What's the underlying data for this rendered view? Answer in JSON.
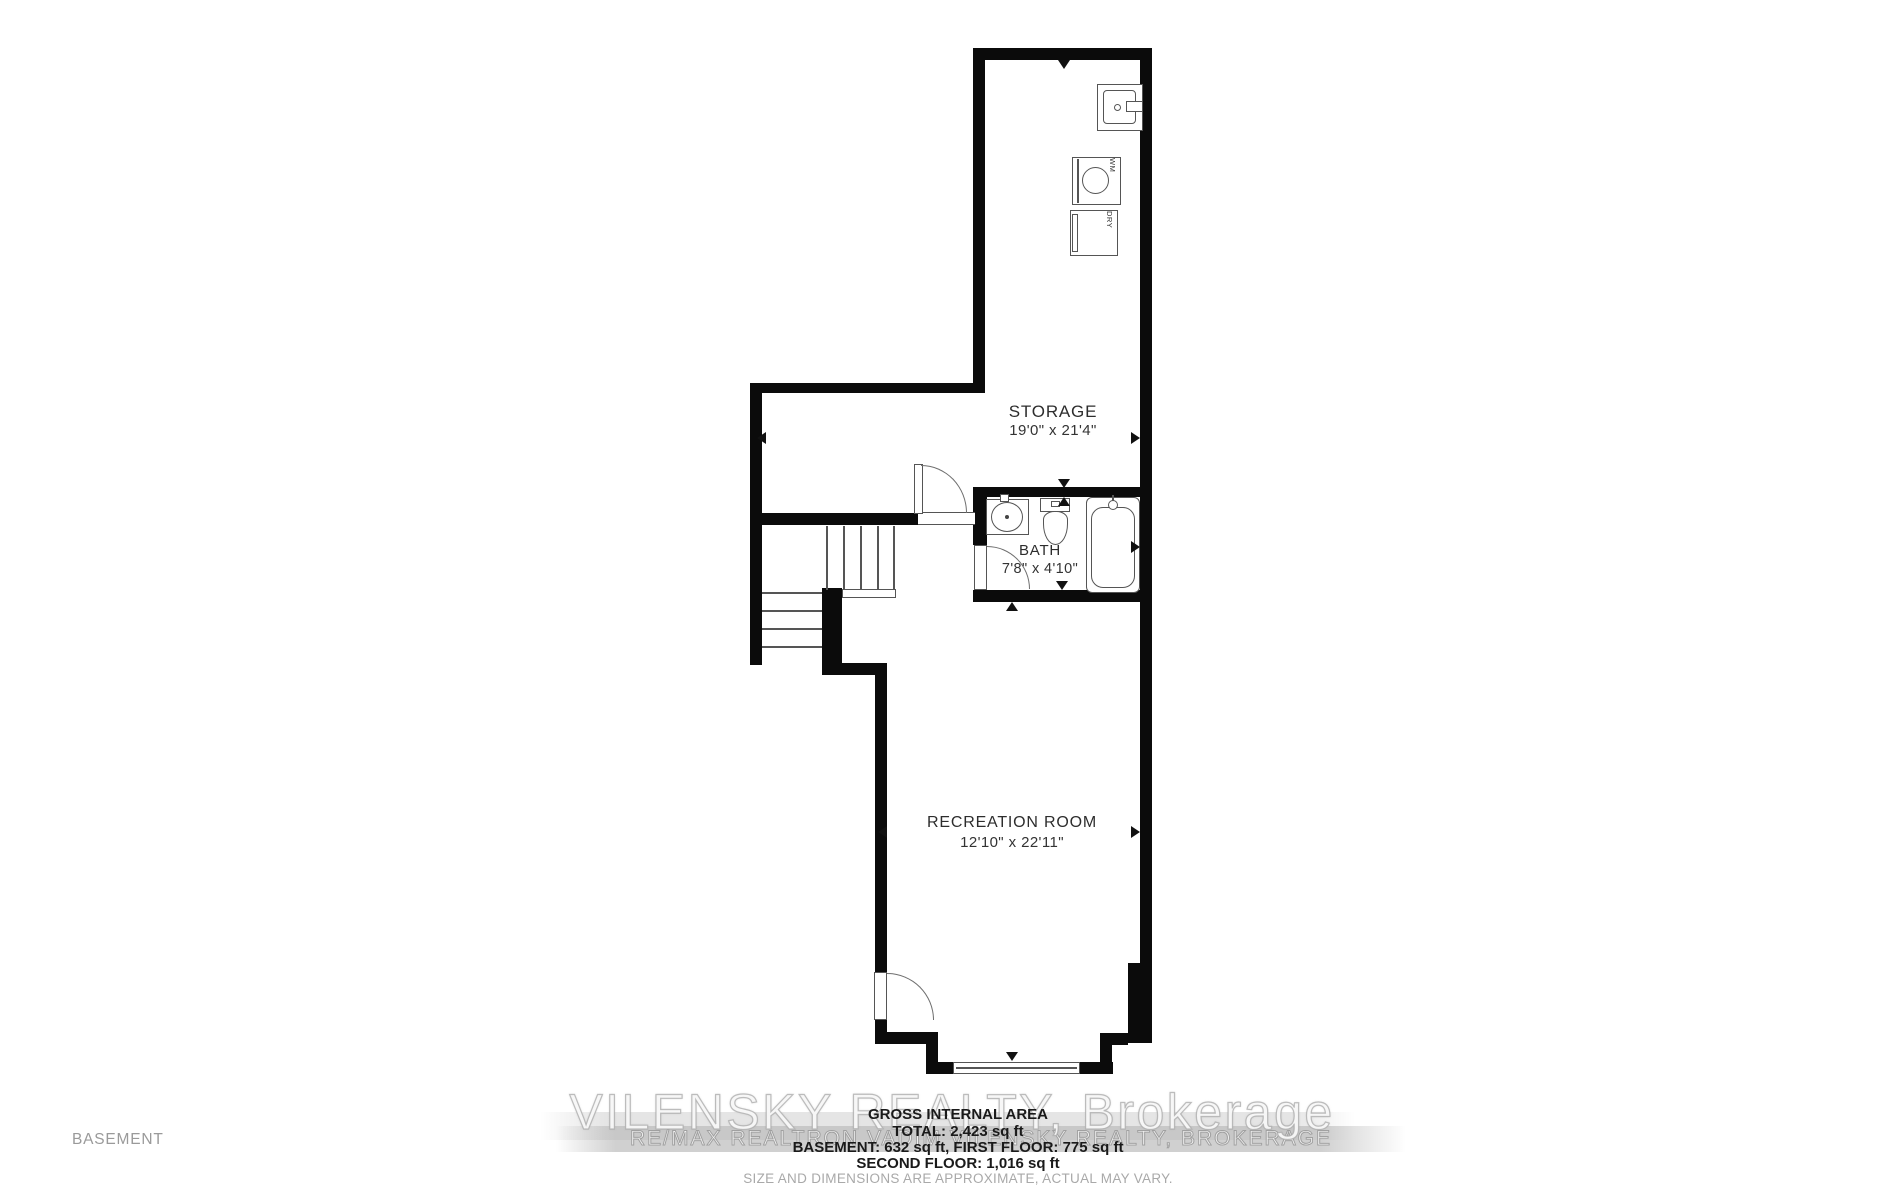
{
  "floor_label": "BASEMENT",
  "rooms": {
    "storage": {
      "name": "STORAGE",
      "dimensions": "19'0\" x 21'4\""
    },
    "bath": {
      "name": "BATH",
      "dimensions": "7'8\" x 4'10\""
    },
    "recreation": {
      "name": "RECREATION ROOM",
      "dimensions": "12'10\" x 22'11\""
    }
  },
  "appliances": {
    "washer_label": "WM",
    "dryer_label": "DRY"
  },
  "watermark": {
    "primary": "VILENSKY REALTY, Brokerage",
    "secondary": "RE/MAX REALTRON VADIM VILENSKY REALTY, BROKERAGE"
  },
  "footer": {
    "title": "GROSS INTERNAL AREA",
    "total": "TOTAL: 2,423 sq ft",
    "floors": "BASEMENT: 632 sq ft, FIRST FLOOR: 775 sq ft",
    "second_floor": "SECOND FLOOR: 1,016 sq ft",
    "disclaimer": "SIZE AND DIMENSIONS ARE APPROXIMATE, ACTUAL MAY VARY."
  },
  "colors": {
    "wall": "#0b0b0b",
    "thin_line": "#555555",
    "label_text": "#2d2d2d",
    "muted_text": "#a9a9a9",
    "watermark_gray": "#bababa"
  }
}
